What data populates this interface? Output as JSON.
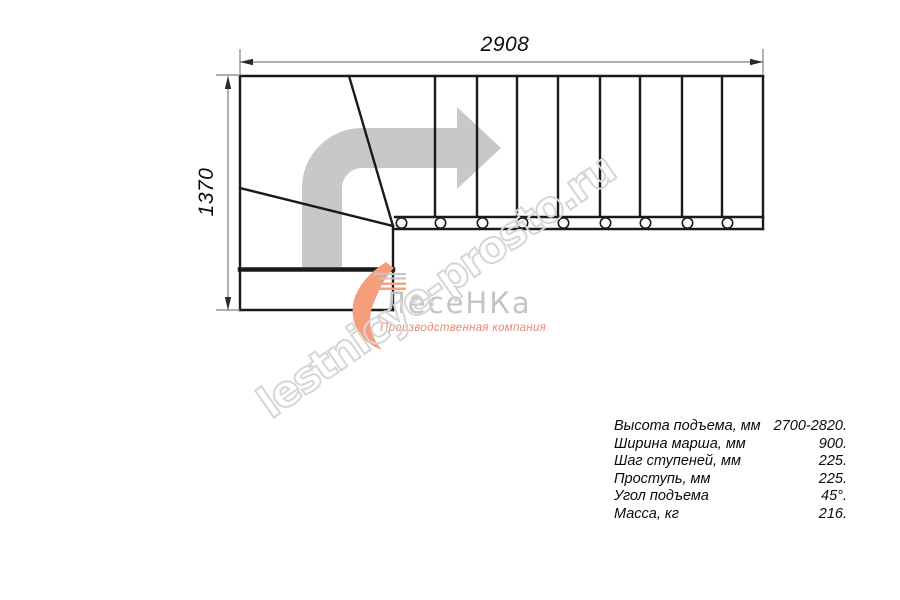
{
  "drawing": {
    "width_label": "2908",
    "height_label": "1370",
    "arrow_icon": "turn-right-direction-arrow",
    "tread_count": 9,
    "colors": {
      "line": "#1a1a1a",
      "dimension_line": "#7f7f7f",
      "direction_arrow": "#c8c8c8",
      "watermark": "#d6d6d6",
      "logo_accent": "#f49e7e",
      "logo_text": "#c4c4c4",
      "logo_subtitle": "#ee8673"
    }
  },
  "watermark": {
    "text": "lestnicye-prosto.ru"
  },
  "logo": {
    "name": "ЛесеНКа",
    "subtitle": "Производственная компания"
  },
  "specs": {
    "rows": [
      {
        "label": "Высота подъема, мм",
        "value": "2700-2820."
      },
      {
        "label": "Ширина марша, мм",
        "value": "900."
      },
      {
        "label": "Шаг ступеней, мм",
        "value": "225."
      },
      {
        "label": "Проступь, мм",
        "value": "225."
      },
      {
        "label": "Угол подъема",
        "value": "45°."
      },
      {
        "label": "Масса, кг",
        "value": "216."
      }
    ]
  }
}
